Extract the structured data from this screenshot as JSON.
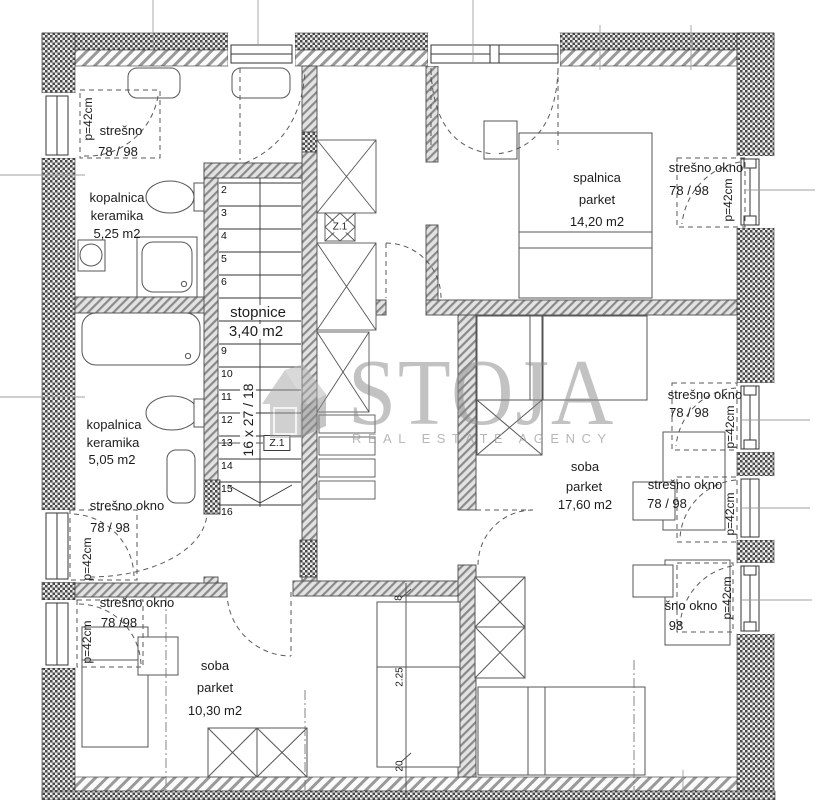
{
  "watermark": {
    "brand": "STOJA",
    "tagline": "REAL ESTATE AGENCY"
  },
  "rooms": {
    "bath_upper": {
      "name": "kopalnica",
      "finish": "keramika",
      "area": "5,25 m2"
    },
    "bedroom": {
      "name": "spalnica",
      "finish": "parket",
      "area": "14,20 m2"
    },
    "stairs_room": {
      "name": "stopnice",
      "area": "3,40 m2"
    },
    "bath_lower": {
      "name": "kopalnica",
      "finish": "keramika",
      "area": "5,05 m2"
    },
    "room_right": {
      "name": "soba",
      "finish": "parket",
      "area": "17,60 m2"
    },
    "room_bottom": {
      "name": "soba",
      "finish": "parket",
      "area": "10,30 m2"
    }
  },
  "stairs": {
    "numbers": [
      "2",
      "3",
      "4",
      "5",
      "6",
      "9",
      "10",
      "11",
      "12",
      "13",
      "14",
      "15",
      "16"
    ],
    "spec": "16 x 27 / 18",
    "shaft_label": "Z.1"
  },
  "roof_windows": {
    "top_left": {
      "name": "strešno",
      "size": "78 / 98",
      "depth": "p=42cm"
    },
    "right_top": {
      "name": "strešno okno",
      "size": "78 / 98",
      "depth": "p=42cm"
    },
    "right_middle": {
      "name": "strešno okno",
      "size": "78 / 98",
      "depth": "p=42cm"
    },
    "right_lower": {
      "name": "strešno okno",
      "size": "78 / 98",
      "depth": "p=42cm"
    },
    "right_bottom": {
      "name": "šno okno",
      "size": "98",
      "depth": "p=42cm"
    },
    "left_middle": {
      "name": "strešno okno",
      "size": "78 / 98",
      "depth": "p=42cm"
    },
    "left_bottom": {
      "name": "strešno okno",
      "size": "78 /98",
      "depth": "p=42cm"
    }
  },
  "dimensions": {
    "d1": "8",
    "d2": "2.25",
    "d3": "20"
  }
}
